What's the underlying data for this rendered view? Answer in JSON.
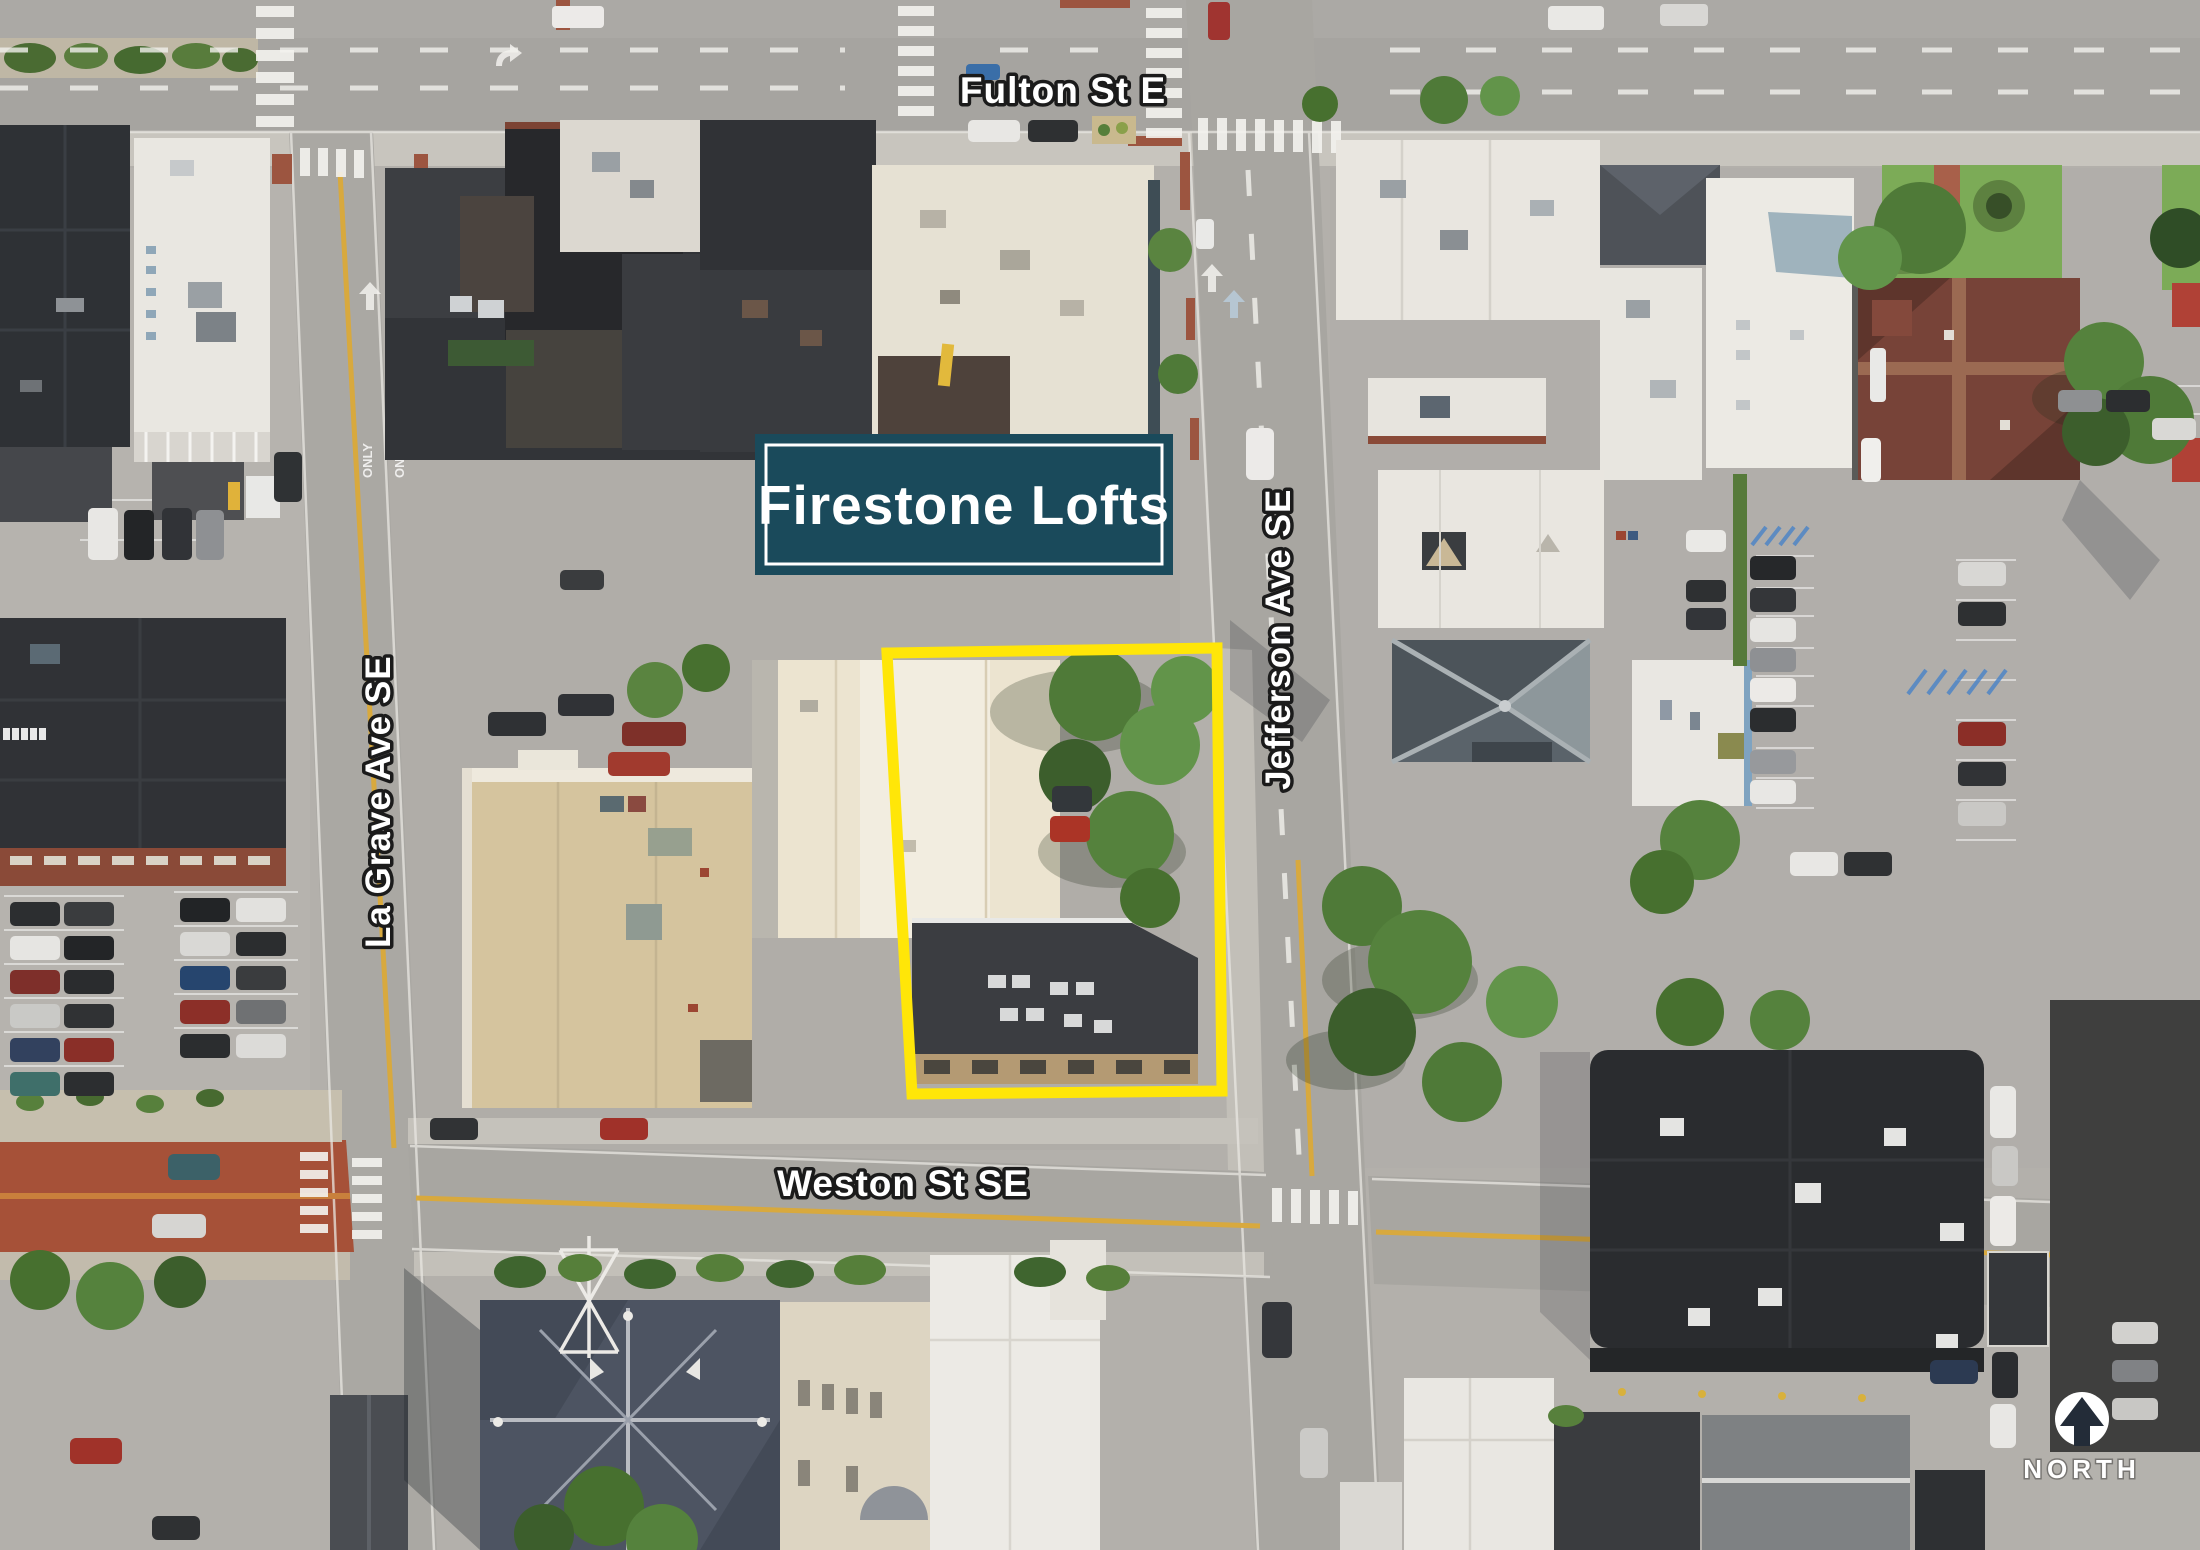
{
  "annotations": {
    "title": "Firestone Lofts",
    "north_label": "NORTH",
    "streets": [
      {
        "name": "Fulton St E",
        "orientation": "horizontal",
        "position": "top"
      },
      {
        "name": "Jefferson Ave SE",
        "orientation": "vertical",
        "position": "right-of-center"
      },
      {
        "name": "La Grave Ave SE",
        "orientation": "vertical",
        "position": "left"
      },
      {
        "name": "Weston St SE",
        "orientation": "horizontal",
        "position": "bottom"
      }
    ],
    "pavement_markings": {
      "only": "ONLY"
    },
    "property_outline": {
      "shape": "rectangle",
      "highlights": "Firestone Lofts development site at Jefferson Ave SE and Weston St SE"
    }
  },
  "colors": {
    "title_box_bg": "#1a4a5b",
    "title_box_border": "#ffffff",
    "title_text": "#ffffff",
    "property_outline": "#ffe608",
    "street_label_fill": "#ffffff",
    "street_label_outline": "#1b1b1b",
    "north_icon_bg": "#ffffff",
    "north_icon_arrow": "#232c38",
    "north_text": "#ffffff",
    "road_gray": "#a8a6a1",
    "red_paving": "#a65138",
    "yellow_center_line": "#d8a93e"
  },
  "map": {
    "type": "aerial-photograph",
    "area": "downtown block bounded by Fulton St E, Jefferson Ave SE, Weston St SE and La Grave Ave SE"
  }
}
